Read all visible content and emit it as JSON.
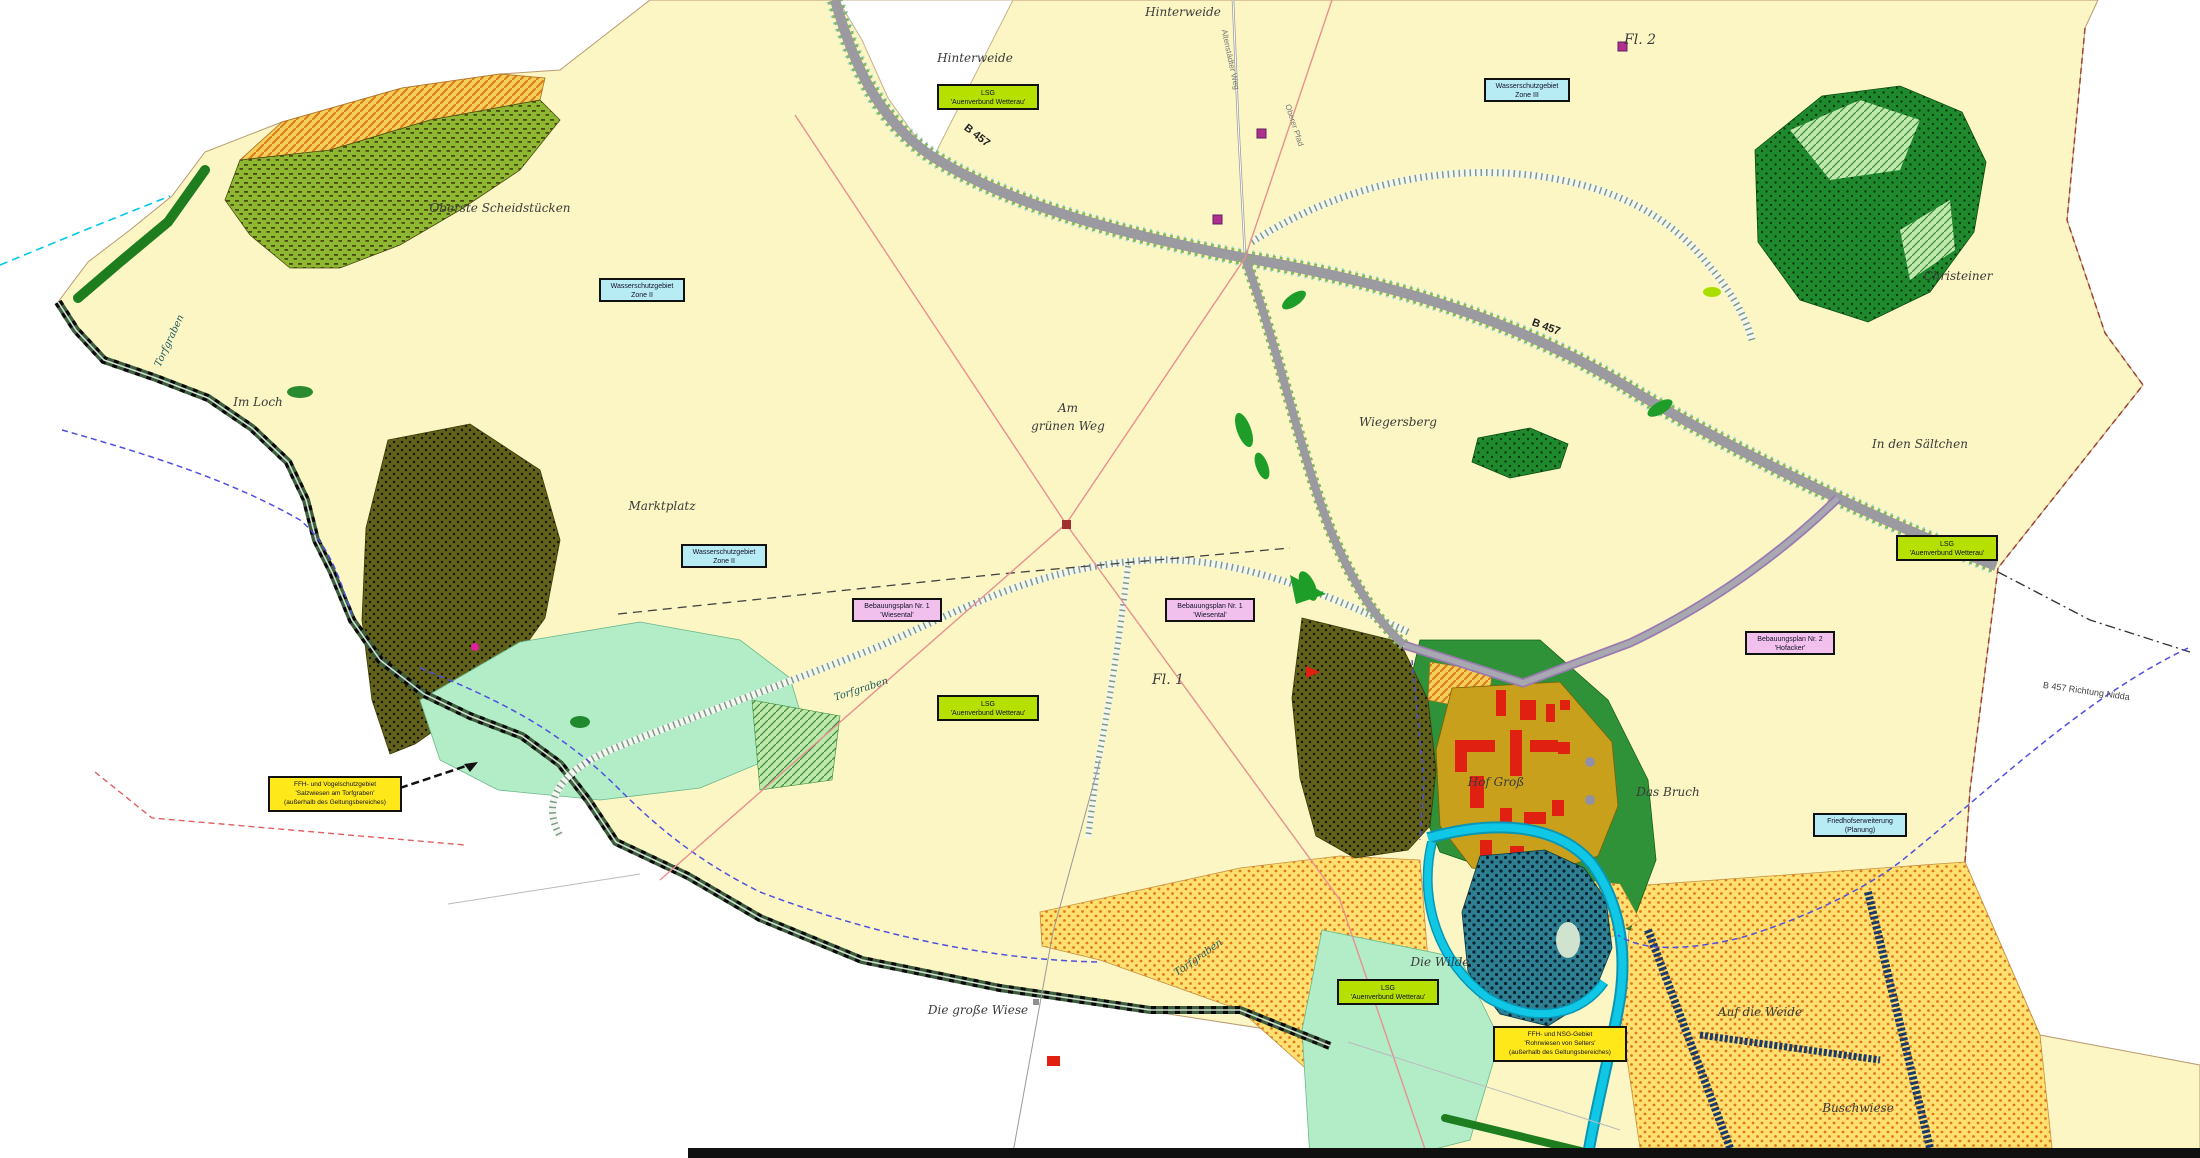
{
  "map": {
    "type": "land-use-plan (Flächennutzungsplan)",
    "colors": {
      "land": "#fbf6c3",
      "background": "#ffffff",
      "forest_olive": "#61611a",
      "forest_green": "#1f8a2d",
      "meadow_light_green": "#b2edc8",
      "field_orange_dots": "#ffe070",
      "wetland_teal": "#2f7f92",
      "stream_cyan": "#10c8e6",
      "road_grey": "#9a9aa0",
      "village_ochre": "#c8a01c",
      "building_red": "#e02010",
      "box_lsg_green": "#b5e000",
      "box_water_cyan": "#b8ecf4",
      "box_bplan_magenta": "#f2c0ec",
      "box_ffh_yellow": "#ffe81a",
      "boundary_dash_blue": "#5050e0",
      "powerline_salmon": "#e89090"
    },
    "labels": [
      {
        "name": "hinterweide-1",
        "text": "Hinterweide"
      },
      {
        "name": "hinterweide-2",
        "text": "Hinterweide"
      },
      {
        "name": "fl-2",
        "text": "Fl. 2"
      },
      {
        "name": "christeiner",
        "text": "Christeiner"
      },
      {
        "name": "in-den-saeltchen",
        "text": "In den Sältchen"
      },
      {
        "name": "wiegersberg",
        "text": "Wiegersberg"
      },
      {
        "name": "am-gruenen-weg-line1",
        "text": "Am"
      },
      {
        "name": "am-gruenen-weg-line2",
        "text": "grünen Weg"
      },
      {
        "name": "marktplatz",
        "text": "Marktplatz"
      },
      {
        "name": "im-loch",
        "text": "Im Loch"
      },
      {
        "name": "oberste-scheidstuecken",
        "text": "Oberste Scheidstücken"
      },
      {
        "name": "fl-1",
        "text": "Fl. 1"
      },
      {
        "name": "hof-gross",
        "text": "Hof Groß"
      },
      {
        "name": "das-bruch",
        "text": "Das Bruch"
      },
      {
        "name": "die-wilde",
        "text": "Die Wilde"
      },
      {
        "name": "die-grosse-wiese",
        "text": "Die große Wiese"
      },
      {
        "name": "auf-die-weide",
        "text": "Auf die Weide"
      },
      {
        "name": "buschwiese",
        "text": "Buschwiese"
      },
      {
        "name": "torfgraben-west",
        "text": "Torfgraben"
      },
      {
        "name": "torfgraben-mitte",
        "text": "Torfgraben"
      },
      {
        "name": "torfgraben-ost",
        "text": "Torfgraben"
      },
      {
        "name": "b457-nord",
        "text": "B 457"
      },
      {
        "name": "b457-ost",
        "text": "B 457"
      },
      {
        "name": "b457-richtung",
        "text": "B 457 Richtung Nidda"
      },
      {
        "name": "weg-nord",
        "text": "Altenstädter Weg"
      },
      {
        "name": "weg-ober",
        "text": "Oberer Pfad"
      }
    ],
    "boxes": [
      {
        "name": "lsg-box-nord",
        "lines": [
          "LSG",
          "'Auenverbund Wetterau'"
        ]
      },
      {
        "name": "wasserschutz-box-mitte",
        "lines": [
          "Wasserschutzgebiet",
          "Zone II"
        ]
      },
      {
        "name": "wasserschutz-box-nordost",
        "lines": [
          "Wasserschutzgebiet",
          "Zone III"
        ]
      },
      {
        "name": "wasserschutz-box-sued",
        "lines": [
          "Wasserschutzgebiet",
          "Zone II"
        ]
      },
      {
        "name": "bebauungsplan-box-1",
        "lines": [
          "Bebauungsplan Nr. 1",
          "'Wiesental'"
        ]
      },
      {
        "name": "bebauungsplan-box-2",
        "lines": [
          "Bebauungsplan Nr. 1",
          "'Wiesental'"
        ]
      },
      {
        "name": "bebauungsplan-box-3",
        "lines": [
          "Bebauungsplan Nr. 2",
          "'Hofacker'"
        ]
      },
      {
        "name": "ffh-box-west",
        "lines": [
          "FFH- und Vogelschutzgebiet",
          "'Salzwiesen am Torfgraben'",
          "(außerhalb des Geltungsbereiches)"
        ]
      },
      {
        "name": "friedhof-box",
        "lines": [
          "Friedhofserweiterung",
          "(Planung)"
        ]
      },
      {
        "name": "lsg-box-mitte",
        "lines": [
          "LSG",
          "'Auenverbund Wetterau'"
        ]
      },
      {
        "name": "lsg-box-sued",
        "lines": [
          "LSG",
          "'Auenverbund Wetterau'"
        ]
      },
      {
        "name": "lsg-box-ost",
        "lines": [
          "LSG",
          "'Auenverbund Wetterau'"
        ]
      },
      {
        "name": "ffh-box-sued",
        "lines": [
          "FFH- und NSG-Gebiet",
          "'Rohrwiesen von Selters'",
          "(außerhalb des Geltungsbereiches)"
        ]
      }
    ]
  }
}
